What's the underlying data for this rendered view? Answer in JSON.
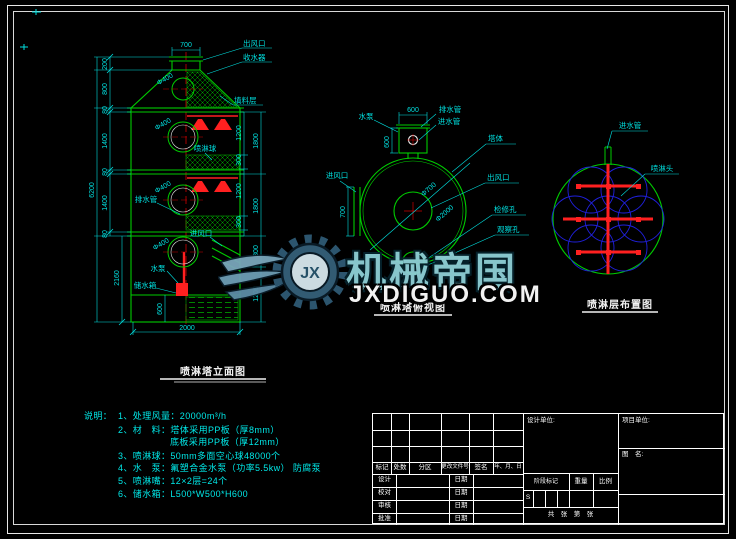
{
  "colors": {
    "background": "#000000",
    "geometry_green": "#00cc00",
    "dimension_cyan": "#00e0e0",
    "nozzle_red": "#ff2020",
    "coverage_blue": "#2020dd",
    "frame_white": "#ffffff",
    "watermark_teal": "#8fd0d6"
  },
  "watermark": {
    "brand": "机械帝国",
    "site": "JXDIGUO.COM",
    "gear_initials": "JX"
  },
  "elevation": {
    "title": "喷淋塔立面图",
    "labels": {
      "air_outlet": "出风口",
      "demister": "收水器",
      "packing_layer": "填料层",
      "packing_ball": "喷淋球",
      "drain_pipe": "排水管",
      "air_inlet": "进风口",
      "water_pump": "水泵",
      "water_tank": "储水箱"
    },
    "dims": {
      "top_width": "700",
      "d200": "200",
      "d800": "800",
      "d80a": "80",
      "d1400a": "1400",
      "d80b": "80",
      "d1400b": "1400",
      "d80c": "80",
      "d2160": "2160",
      "overall": "6200",
      "tank_h": "600",
      "bottom_w": "2000",
      "r1200a": "1200",
      "r300a": "300",
      "r1200b": "1200",
      "r300b": "300",
      "r1800a": "1800",
      "r1800b": "1800",
      "r300c": "300",
      "r1200c": "1200",
      "manhole": "Φ400"
    }
  },
  "top_view": {
    "title": "喷淋塔俯视图",
    "labels": {
      "pump": "水泵",
      "drain": "排水管",
      "inlet_pipe": "进水管",
      "tower": "塔体",
      "air_outlet": "出风口",
      "manhole": "检修孔",
      "observe": "观察孔",
      "air_inlet": "进风口"
    },
    "dims": {
      "box_w": "600",
      "box_h": "600",
      "inlet_h": "700",
      "inner": "Φ700",
      "outer": "Φ2000"
    }
  },
  "spray_layout": {
    "title": "喷淋层布置图",
    "labels": {
      "inlet_pipe": "进水管",
      "nozzle": "喷淋头"
    }
  },
  "notes": {
    "heading": "说明：",
    "lines": [
      "1、处理风量：20000m³/h",
      "2、材　料：塔体采用PP板（厚8mm）",
      "底板采用PP板（厚12mm）",
      "3、喷淋球：50mm多面空心球48000个",
      "4、水　泵：氟塑合金水泵（功率5.5kw） 防腐泵",
      "5、喷淋嘴：12×2层=24个",
      "6、储水箱：L500*W500*H600"
    ]
  },
  "title_block": {
    "c_mark": "标记",
    "c_count": "处数",
    "c_zone": "分区",
    "c_file": "更改文件号",
    "c_sign": "签名",
    "c_date": "年、月、日",
    "r_design": "设计",
    "r_check": "校对",
    "r_review": "审核",
    "r_approve": "批准",
    "date_label": "日期",
    "design_unit": "设计单位:",
    "project_unit": "项目单位:",
    "drawing_name": "图　名:",
    "stage": "阶段标记",
    "weight": "重量",
    "scale": "比例",
    "s_mark": "S",
    "sheets": "共　张　第　张"
  }
}
